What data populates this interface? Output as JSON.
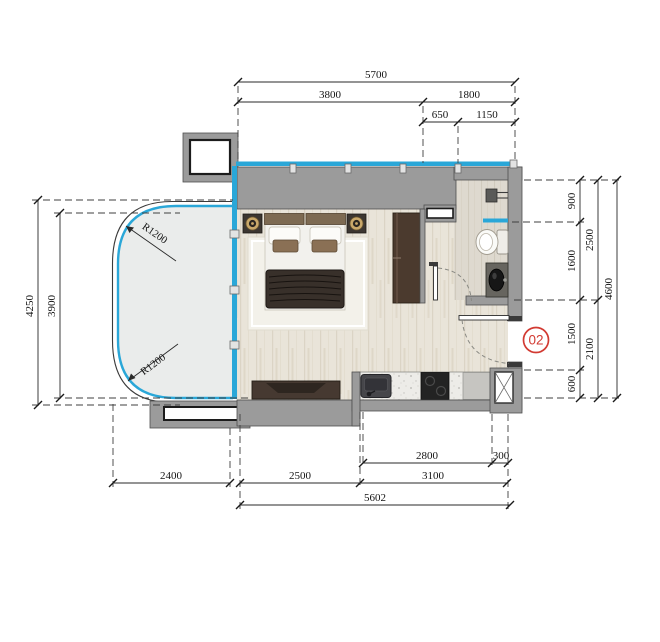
{
  "unit": {
    "number": "02"
  },
  "annotations": {
    "radius_top": "R1200",
    "radius_bottom": "R1200"
  },
  "dimensions": {
    "top": {
      "total": "5700",
      "left": "3800",
      "right": "1800",
      "sub_left": "650",
      "sub_right": "1150"
    },
    "left": {
      "outer": "4250",
      "inner": "3900"
    },
    "right": {
      "shower": "900",
      "bath": "1600",
      "hall": "1500",
      "entry": "600",
      "upper": "2500",
      "lower": "2100",
      "total": "4600"
    },
    "bottom": {
      "kitchen": "2800",
      "shaft": "300",
      "balcony": "2400",
      "living": "2500",
      "kitchen_total": "3100",
      "total": "5602"
    }
  },
  "colors": {
    "glass": "#2aa7d8",
    "wall": "#9b9b9b",
    "accent": "#d23a32"
  }
}
